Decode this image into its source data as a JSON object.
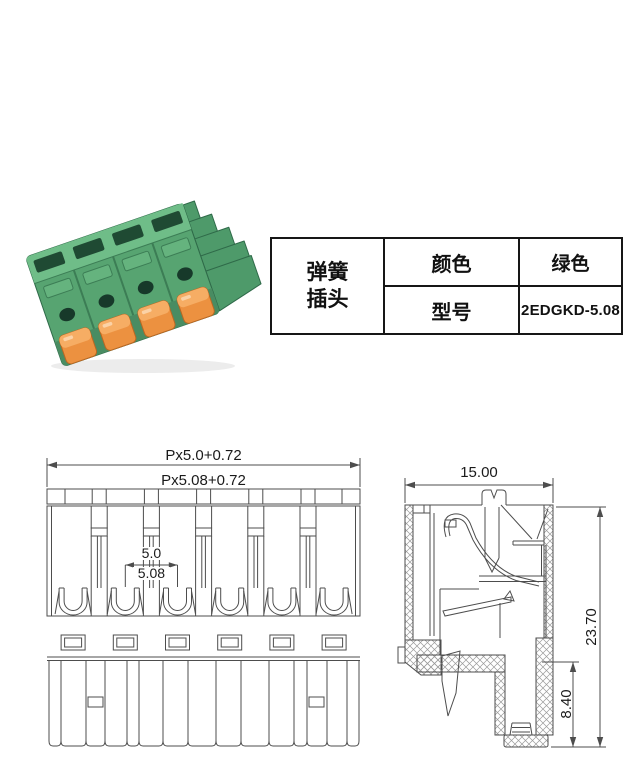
{
  "photo": {
    "description": "green spring-cage pluggable terminal block plug with orange release levers",
    "positions": 4,
    "body_color": "#57a471",
    "lever_color": "#ec9140"
  },
  "spec_table": {
    "product_name_lines": [
      "弹簧",
      "插头"
    ],
    "rows": [
      {
        "label": "颜色",
        "value": "绿色"
      },
      {
        "label": "型号",
        "value": "2EDGKD-5.08"
      }
    ]
  },
  "front_view": {
    "positions": 6,
    "dim_overall_pitch50": "Px5.0+0.72",
    "dim_overall_pitch508": "Px5.08+0.72",
    "dim_pitch50": "5.0",
    "dim_pitch508": "5.08"
  },
  "side_view": {
    "dim_width_mm": "15.00",
    "dim_height_mm": "23.70",
    "dim_lower_mm": "8.40"
  }
}
